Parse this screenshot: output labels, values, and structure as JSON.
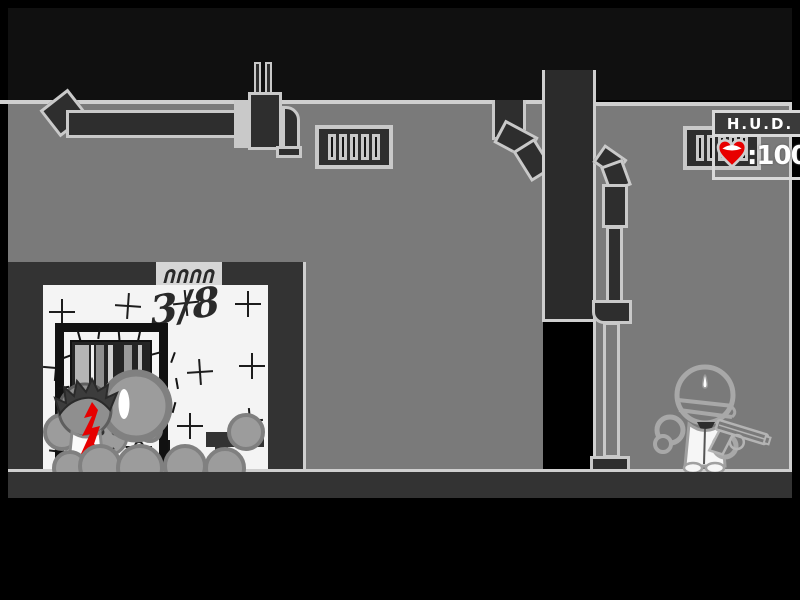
{
  "hud": {
    "title": "H.U.D.",
    "health": "100",
    "health_display": ":100",
    "heart_icon": "heart"
  },
  "room": {
    "counter": "3/8"
  },
  "colors": {
    "blood_red": "#e60000",
    "heart_red": "#e80000",
    "wall_gray": "#7a7a7a",
    "structure_dark": "#2e2e2e",
    "band_dark": "#333333",
    "outline_light": "#cfcfcf",
    "room_white": "#f4f4f4"
  }
}
